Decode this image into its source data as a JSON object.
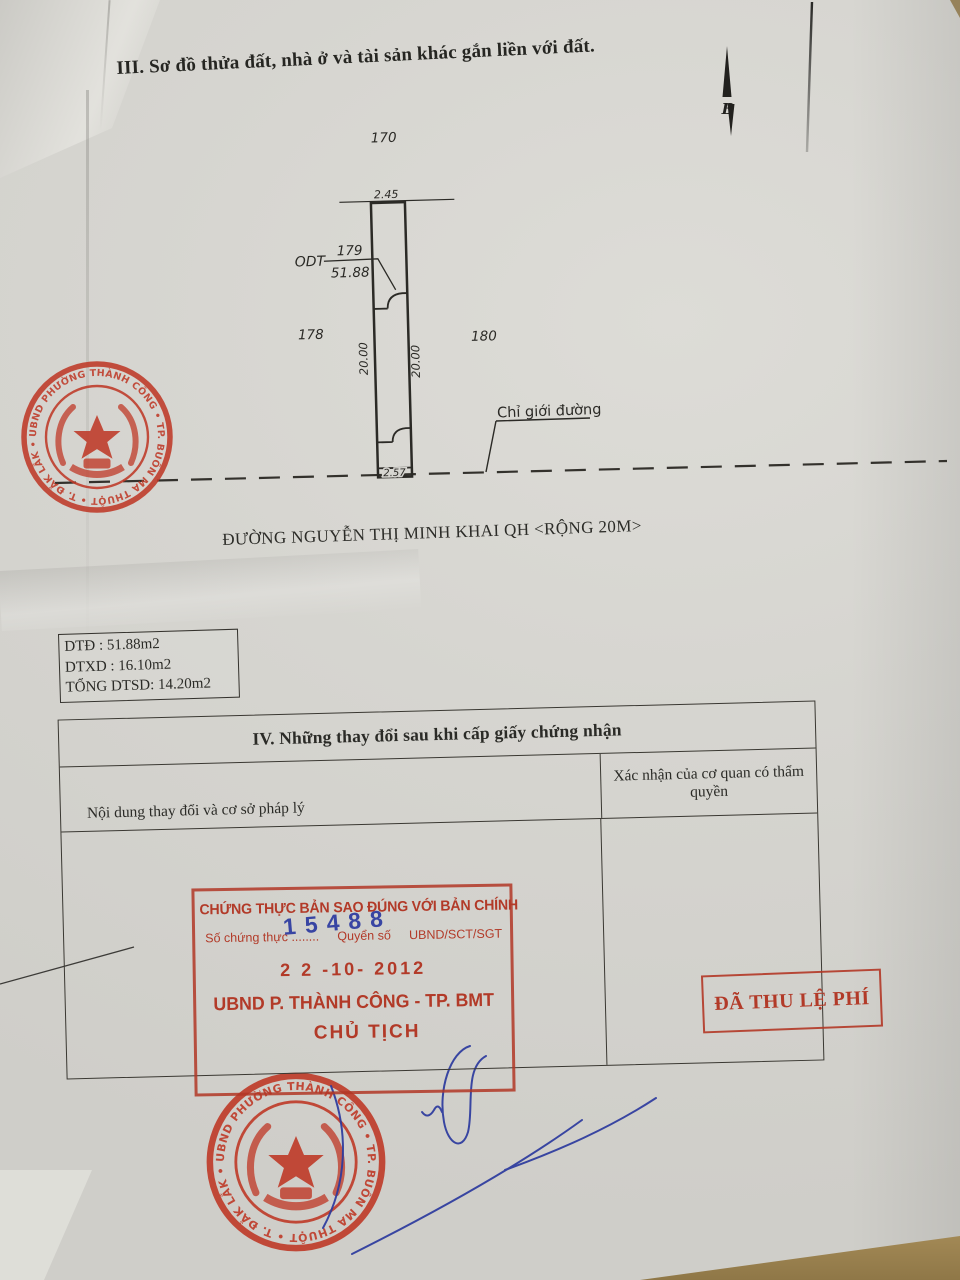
{
  "page_title": "III. Sơ đồ thửa đất, nhà ở và tài sản khác gắn liền với đất.",
  "street_label": "ĐƯỜNG NGUYỄN THỊ MINH KHAI QH <RỘNG 20M>",
  "diagram": {
    "parcel_top": "170",
    "parcel_left": "178",
    "parcel_right": "180",
    "parcel_number": "179",
    "land_use_code": "ODT",
    "area": "51.88",
    "width_top": "2.45",
    "width_bottom": "2.57",
    "depth_left": "20.00",
    "depth_right": "20.00",
    "road_boundary_label": "Chỉ giới đường",
    "north_label": "B"
  },
  "area_box": {
    "line1": "DTĐ : 51.88m2",
    "line2": "DTXD : 16.10m2",
    "line3": "TỔNG DTSD: 14.20m2"
  },
  "section4": {
    "title": "IV. Những thay đổi sau khi cấp giấy chứng nhận",
    "col_content": "Nội dung thay đổi và cơ sở pháp lý",
    "col_confirm": "Xác nhận của cơ quan có thẩm quyền"
  },
  "cert_stamp": {
    "line1": "CHỨNG THỰC BẢN SAO ĐÚNG VỚI BẢN CHÍNH",
    "serial_label": "Số chứng thực ........",
    "book_label": "Quyển số",
    "office_code": "UBND/SCT/SGT",
    "serial_number": "15488",
    "date": "2 2  -10-  2012",
    "issuer": "UBND P. THÀNH CÔNG - TP. BMT",
    "signer_role": "CHỦ TỊCH"
  },
  "fee_stamp": {
    "label": "ĐÃ THU LỆ PHÍ"
  },
  "seal": {
    "ring_text": "UBND PHƯỜNG THÀNH CÔNG • TP. BUÔN MA THUỘT • T. ĐẮK LẮK •",
    "ring_text_bottom": "UBND PHƯỜNG THÀNH CÔNG • TP. BUÔN MA THUỘT • T. ĐẮK LẮK •"
  },
  "colors": {
    "stamp_red": "#b23a28",
    "ink_blue": "#2c3a9e",
    "paper": "#d6d5d0"
  }
}
